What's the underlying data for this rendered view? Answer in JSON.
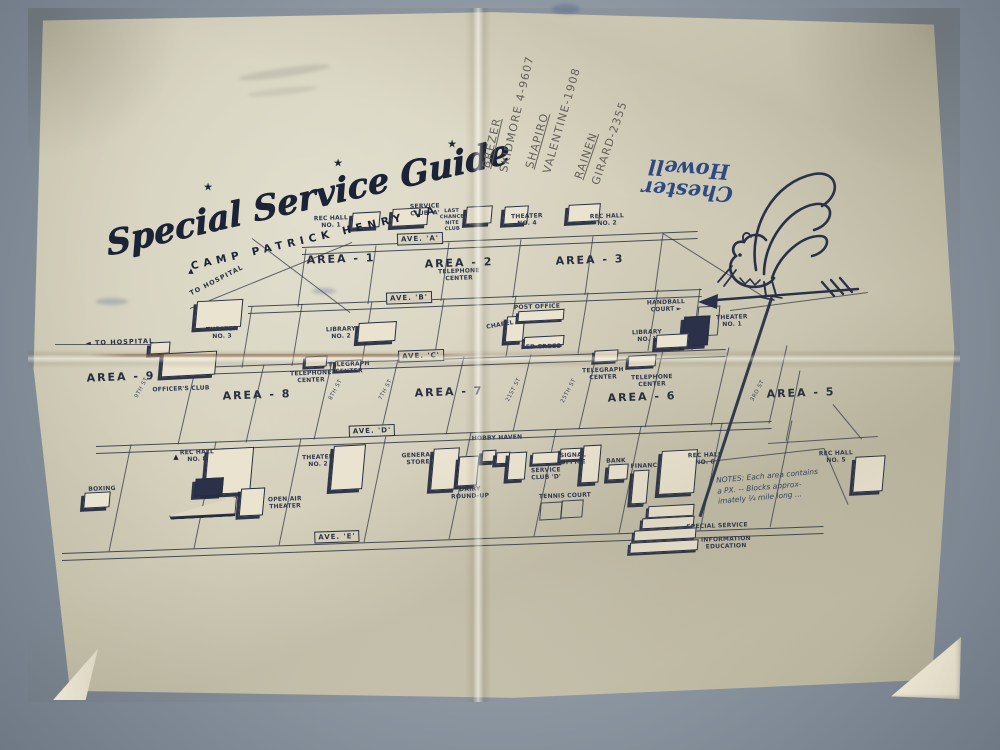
{
  "photo": {
    "table_color": "#8d97a2",
    "paper_color": "#d3cfba",
    "ink_color": "#262d42"
  },
  "title": {
    "main": "Special Service Guide",
    "sub": "CAMP PATRICK HENRY VA"
  },
  "annotations": {
    "pencil_contacts": [
      {
        "name": "BREZER",
        "phone": "SKIDMORE 4-9607"
      },
      {
        "name": "SHAPIRO",
        "phone": "VALENTINE-1908"
      },
      {
        "name": "RAINEN",
        "phone": "GIRARD-2355"
      }
    ],
    "signature": {
      "line1": "Chester",
      "line2": "Howell",
      "ink_color": "#2c4a86"
    }
  },
  "map": {
    "labels": [
      {
        "t": "★",
        "x": 208,
        "y": 187,
        "c": "star",
        "r": 0
      },
      {
        "t": "★",
        "x": 338,
        "y": 163,
        "c": "star",
        "r": 0
      },
      {
        "t": "★",
        "x": 452,
        "y": 144,
        "c": "star",
        "r": 0
      },
      {
        "t": "REC HALL\nNO. 1",
        "x": 331,
        "y": 222,
        "c": "bldg"
      },
      {
        "t": "SERVICE\nCLUB 'A'",
        "x": 425,
        "y": 210,
        "c": "bldg"
      },
      {
        "t": "LAST\nCHANCE\nNITE\nCLUB",
        "x": 452,
        "y": 220,
        "c": "bldg",
        "s": 5
      },
      {
        "t": "THEATER\nNO. 4",
        "x": 527,
        "y": 220,
        "c": "bldg"
      },
      {
        "t": "REC HALL\nNO. 2",
        "x": 607,
        "y": 220,
        "c": "bldg"
      },
      {
        "t": "TELEPHONE\nCENTER",
        "x": 459,
        "y": 275,
        "c": "bldg"
      },
      {
        "t": "TO HOSPITAL",
        "x": 217,
        "y": 281,
        "c": "dir",
        "r": -27
      },
      {
        "t": "▲",
        "x": 191,
        "y": 271,
        "c": "mark",
        "r": 0
      },
      {
        "t": "THEATER\nNO. 3",
        "x": 222,
        "y": 333,
        "c": "bldg"
      },
      {
        "t": "◄ TO HOSPITAL",
        "x": 120,
        "y": 343,
        "c": "dir"
      },
      {
        "t": "OFFICER'S CLUB",
        "x": 181,
        "y": 389,
        "c": "bldg"
      },
      {
        "t": "LIBRARY\nNO. 2",
        "x": 341,
        "y": 333,
        "c": "bldg"
      },
      {
        "t": "CHAPEL",
        "x": 500,
        "y": 325,
        "c": "bldg",
        "r": -10
      },
      {
        "t": "POST OFFICE",
        "x": 537,
        "y": 307,
        "c": "bldg"
      },
      {
        "t": "RED CROSS",
        "x": 541,
        "y": 347,
        "c": "bldg"
      },
      {
        "t": "HANDBALL\nCOURT ►",
        "x": 666,
        "y": 306,
        "c": "bldg"
      },
      {
        "t": "THEATER\nNO. 1",
        "x": 732,
        "y": 321,
        "c": "bldg"
      },
      {
        "t": "LIBRARY\nNO. 1",
        "x": 647,
        "y": 336,
        "c": "bldg"
      },
      {
        "t": "TELEPHONE\nCENTER",
        "x": 311,
        "y": 377,
        "c": "bldg"
      },
      {
        "t": "TELEGRAPH\nCENTER",
        "x": 349,
        "y": 368,
        "c": "bldg"
      },
      {
        "t": "TELEGRAPH\nCENTER",
        "x": 603,
        "y": 374,
        "c": "bldg"
      },
      {
        "t": "TELEPHONE\nCENTER",
        "x": 652,
        "y": 381,
        "c": "bldg"
      },
      {
        "t": "HOBBY HAVEN",
        "x": 497,
        "y": 438,
        "c": "bldg"
      },
      {
        "t": "REC HALL\nNO. 8",
        "x": 197,
        "y": 456,
        "c": "bldg"
      },
      {
        "t": "OPEN AIR\nTHEATER",
        "x": 285,
        "y": 503,
        "c": "bldg"
      },
      {
        "t": "BOXING",
        "x": 102,
        "y": 489,
        "c": "bldg"
      },
      {
        "t": "THEATER\nNO. 2",
        "x": 318,
        "y": 461,
        "c": "bldg"
      },
      {
        "t": "GENERAL\nSTORE",
        "x": 418,
        "y": 459,
        "c": "bldg"
      },
      {
        "t": "DAIRY\nROUND-UP",
        "x": 470,
        "y": 493,
        "c": "bldg"
      },
      {
        "t": "SERVICE\nCLUB 'D'",
        "x": 546,
        "y": 474,
        "c": "bldg"
      },
      {
        "t": "SIGNAL\nOFFICE",
        "x": 573,
        "y": 459,
        "c": "bldg"
      },
      {
        "t": "TENNIS COURT",
        "x": 565,
        "y": 496,
        "c": "bldg"
      },
      {
        "t": "BANK",
        "x": 616,
        "y": 461,
        "c": "bldg"
      },
      {
        "t": "FINANCE",
        "x": 646,
        "y": 466,
        "c": "bldg"
      },
      {
        "t": "REC HALL\nNO. 6",
        "x": 705,
        "y": 459,
        "c": "bldg"
      },
      {
        "t": "REC HALL\nNO. 5",
        "x": 836,
        "y": 457,
        "c": "bldg"
      },
      {
        "t": "SPECIAL SERVICE",
        "x": 717,
        "y": 526,
        "c": "bldg"
      },
      {
        "t": "INFORMATION\nEDUCATION",
        "x": 726,
        "y": 543,
        "c": "bldg"
      },
      {
        "t": "▲",
        "x": 176,
        "y": 457,
        "c": "mark",
        "r": 0
      },
      {
        "t": "NOTES: Each area contains\na PX. -- Blocks approx-\nimately ¼ mile long ...",
        "x": 768,
        "y": 487,
        "c": "note",
        "r": -5
      },
      {
        "t": "AREA - 1",
        "x": 341,
        "y": 259,
        "c": "area"
      },
      {
        "t": "AREA - 2",
        "x": 459,
        "y": 263,
        "c": "area"
      },
      {
        "t": "AREA - 3",
        "x": 590,
        "y": 260,
        "c": "area"
      },
      {
        "t": "AREA - 9",
        "x": 121,
        "y": 377,
        "c": "area"
      },
      {
        "t": "AREA - 8",
        "x": 257,
        "y": 395,
        "c": "area"
      },
      {
        "t": "AREA - 7",
        "x": 449,
        "y": 392,
        "c": "area"
      },
      {
        "t": "AREA - 6",
        "x": 642,
        "y": 397,
        "c": "area"
      },
      {
        "t": "AREA - 5",
        "x": 801,
        "y": 393,
        "c": "area"
      },
      {
        "t": "AVE. 'A'",
        "x": 420,
        "y": 239,
        "c": "ave"
      },
      {
        "t": "AVE. 'B'",
        "x": 409,
        "y": 298,
        "c": "ave"
      },
      {
        "t": "AVE. 'C'",
        "x": 421,
        "y": 356,
        "c": "ave"
      },
      {
        "t": "AVE. 'D'",
        "x": 372,
        "y": 431,
        "c": "ave"
      },
      {
        "t": "AVE. 'E'",
        "x": 337,
        "y": 537,
        "c": "ave"
      },
      {
        "t": "9TH ST",
        "x": 142,
        "y": 388,
        "c": "street",
        "r": -62
      },
      {
        "t": "8TH ST",
        "x": 336,
        "y": 390,
        "c": "street",
        "r": -62
      },
      {
        "t": "7TH ST",
        "x": 386,
        "y": 390,
        "c": "street",
        "r": -62
      },
      {
        "t": "21ST ST",
        "x": 514,
        "y": 390,
        "c": "street",
        "r": -62
      },
      {
        "t": "25TH ST",
        "x": 569,
        "y": 391,
        "c": "street",
        "r": -62
      },
      {
        "t": "3RD ST",
        "x": 758,
        "y": 391,
        "c": "street",
        "r": -62
      }
    ]
  }
}
